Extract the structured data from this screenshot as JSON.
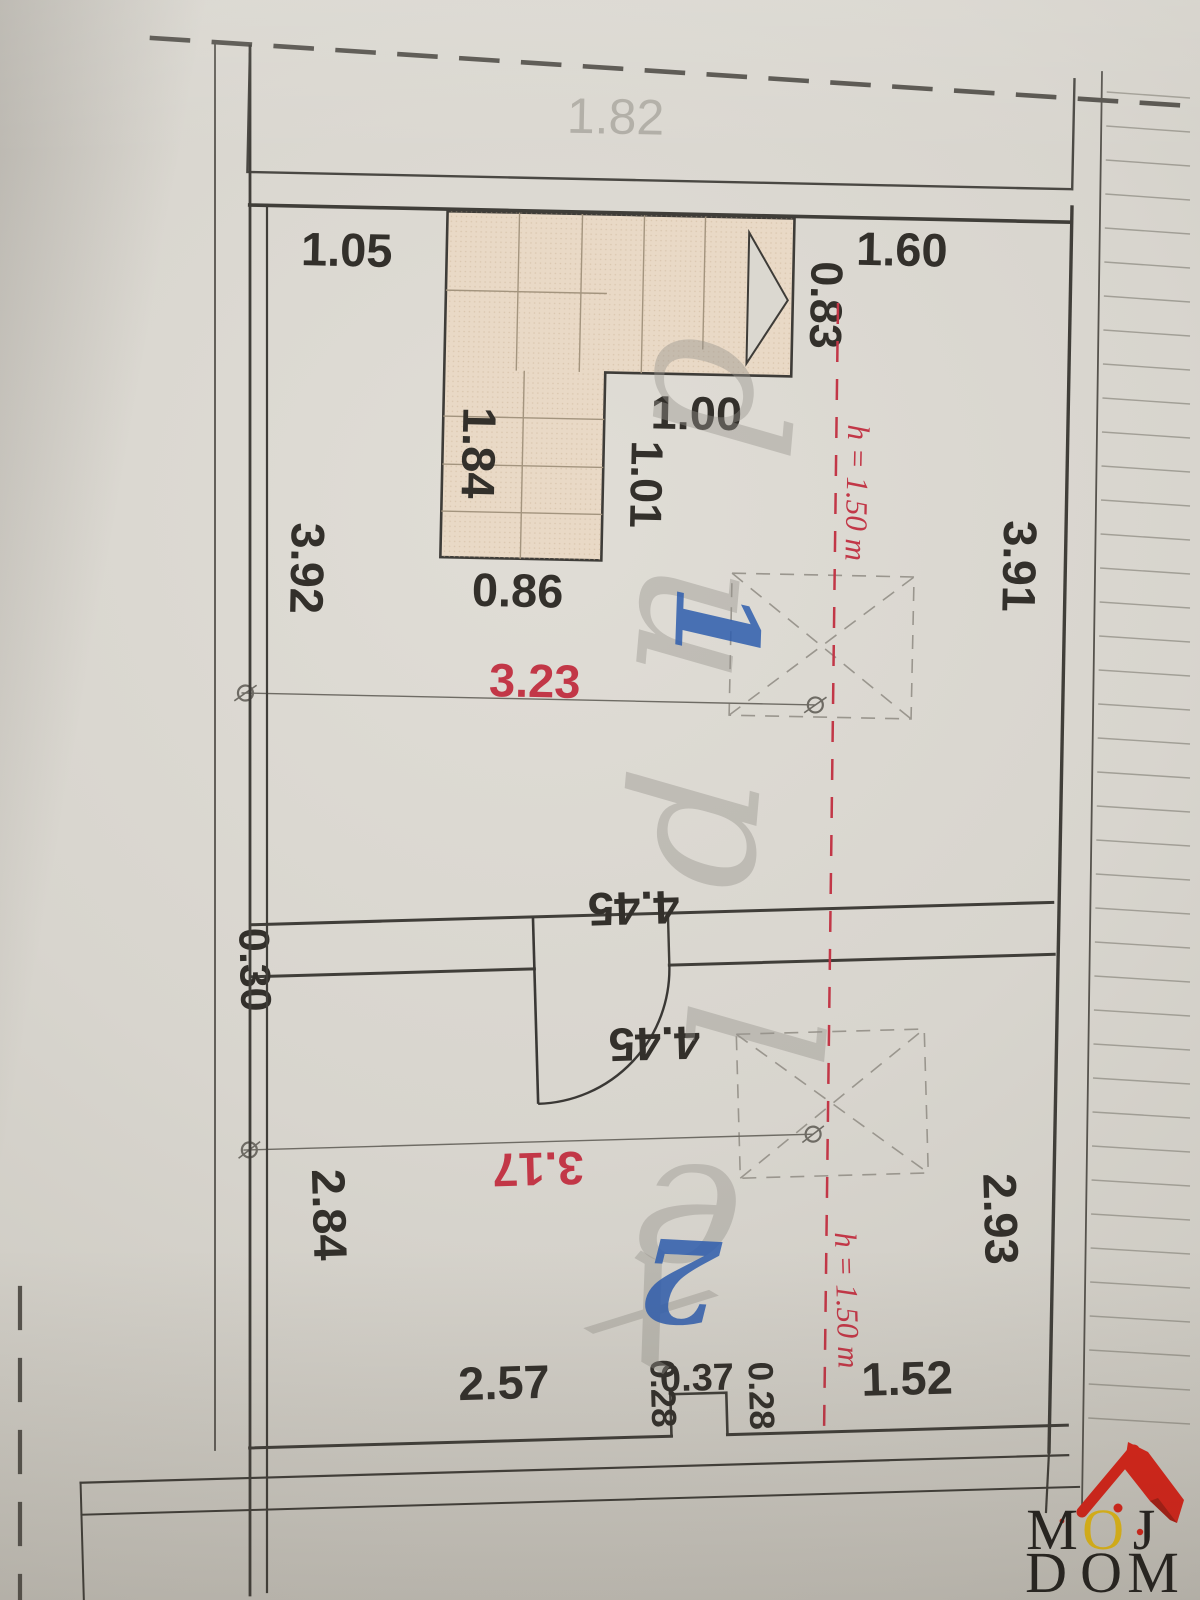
{
  "image": {
    "title": "Floor plan photo - attic duplex level",
    "width": 1200,
    "height": 1600
  },
  "colors": {
    "paper": "#d8d5ce",
    "ink": "#33302b",
    "wall": "#403e39",
    "red": "#c23747",
    "gray": "#b1aea6",
    "watermark": "#96938d",
    "blue": "#2e5dad",
    "stair_fill": "#e9d9c6",
    "stair_step": "#a3947e",
    "hatch": "#8f8c83",
    "dim_line": "#6e6b64",
    "logo_red": "#d92318",
    "logo_yellow": "#e5bb16",
    "logo_black": "#22201d"
  },
  "labels": [
    {
      "t": "1.82",
      "x": 614,
      "y": 126,
      "r": 0,
      "s": 50,
      "c": "gray",
      "g": "upper",
      "w": 400,
      "role": "balcony-width"
    },
    {
      "t": "1.05",
      "x": 348,
      "y": 264,
      "r": 0,
      "s": 47,
      "c": "ink",
      "g": "upper",
      "role": "dimension"
    },
    {
      "t": "1.60",
      "x": 903,
      "y": 252,
      "r": 0,
      "s": 47,
      "c": "ink",
      "g": "upper",
      "role": "dimension"
    },
    {
      "t": "0.83",
      "x": 813,
      "y": 293,
      "r": 90,
      "s": 45,
      "c": "ink",
      "g": "upper",
      "role": "dimension"
    },
    {
      "t": "1.84",
      "x": 468,
      "y": 448,
      "r": 90,
      "s": 47,
      "c": "ink",
      "g": "upper",
      "role": "dimension"
    },
    {
      "t": "1.00",
      "x": 701,
      "y": 420,
      "r": 0,
      "s": 47,
      "c": "ink",
      "g": "upper",
      "role": "dimension"
    },
    {
      "t": "1.01",
      "x": 637,
      "y": 476,
      "r": 90,
      "s": 45,
      "c": "ink",
      "g": "upper",
      "role": "dimension"
    },
    {
      "t": "3.92",
      "x": 299,
      "y": 567,
      "r": 90,
      "s": 47,
      "c": "ink",
      "g": "upper",
      "role": "dimension"
    },
    {
      "t": "3.91",
      "x": 1011,
      "y": 550,
      "r": 90,
      "s": 47,
      "c": "ink",
      "g": "upper",
      "role": "dimension"
    },
    {
      "t": "0.86",
      "x": 526,
      "y": 601,
      "r": 0,
      "s": 47,
      "c": "ink",
      "g": "upper",
      "role": "dimension"
    },
    {
      "t": "3.23",
      "x": 545,
      "y": 691,
      "r": 0,
      "s": 47,
      "c": "red",
      "g": "upper",
      "role": "room-width"
    },
    {
      "t": "h = 1.50 m",
      "x": 853,
      "y": 480,
      "r": 90,
      "s": 31,
      "c": "red",
      "g": "upper",
      "i": 1,
      "role": "height-note"
    },
    {
      "t": "4.45",
      "x": 649,
      "y": 903,
      "r": 180,
      "s": 47,
      "c": "ink",
      "g": "lower",
      "role": "dimension"
    },
    {
      "t": "4.45",
      "x": 666,
      "y": 1039,
      "r": 180,
      "s": 47,
      "c": "ink",
      "g": "lower",
      "role": "dimension"
    },
    {
      "t": "0.30",
      "x": 254,
      "y": 970,
      "r": 90,
      "s": 43,
      "c": "ink",
      "g": "lower",
      "role": "wall-thickness"
    },
    {
      "t": "3.17",
      "x": 546,
      "y": 1161,
      "r": 180,
      "s": 47,
      "c": "red",
      "g": "lower",
      "role": "room-width"
    },
    {
      "t": "2.84",
      "x": 320,
      "y": 1217,
      "r": 90,
      "s": 47,
      "c": "ink",
      "g": "lower",
      "role": "dimension"
    },
    {
      "t": "2.93",
      "x": 991,
      "y": 1240,
      "r": 90,
      "s": 47,
      "c": "ink",
      "g": "lower",
      "role": "dimension"
    },
    {
      "t": "2.57",
      "x": 506,
      "y": 1406,
      "r": 0,
      "s": 47,
      "c": "ink",
      "g": "lower",
      "role": "dimension"
    },
    {
      "t": "0.37",
      "x": 699,
      "y": 1403,
      "r": 0,
      "s": 38,
      "c": "ink",
      "g": "lower",
      "role": "dimension"
    },
    {
      "t": "0.28",
      "x": 653,
      "y": 1405,
      "r": 90,
      "s": 35,
      "c": "ink",
      "g": "lower",
      "role": "dimension"
    },
    {
      "t": "0.28",
      "x": 751,
      "y": 1410,
      "r": 90,
      "s": 35,
      "c": "ink",
      "g": "lower",
      "role": "dimension"
    },
    {
      "t": "1.52",
      "x": 909,
      "y": 1413,
      "r": 0,
      "s": 47,
      "c": "ink",
      "g": "lower",
      "role": "dimension"
    },
    {
      "t": "h = 1.50 m",
      "x": 841,
      "y": 1317,
      "r": 90,
      "s": 31,
      "c": "red",
      "g": "lower",
      "i": 1,
      "role": "height-note"
    }
  ],
  "watermark_letters": [
    {
      "t": "d",
      "x": 655,
      "y": 392,
      "r": 95
    },
    {
      "t": "u",
      "x": 640,
      "y": 618,
      "r": 95
    },
    {
      "t": "p",
      "x": 660,
      "y": 826,
      "r": 95
    },
    {
      "t": "l",
      "x": 686,
      "y": 1028,
      "r": 95
    },
    {
      "t": "e",
      "x": 692,
      "y": 1166,
      "r": 185
    },
    {
      "t": "x",
      "x": 628,
      "y": 1354,
      "r": 30
    }
  ],
  "room_numbers": [
    {
      "t": "1",
      "x": 676,
      "y": 624,
      "r": 92
    },
    {
      "t": "2",
      "x": 682,
      "y": 1240,
      "r": 183
    }
  ],
  "logo": {
    "line1": "MOJ",
    "line2": "DOM",
    "accent_letter": "O",
    "line1_x": [
      1052,
      1103,
      1144
    ],
    "line2_x": [
      1046,
      1101,
      1153
    ],
    "line1_baseline": 1549,
    "line2_baseline": 1592
  }
}
